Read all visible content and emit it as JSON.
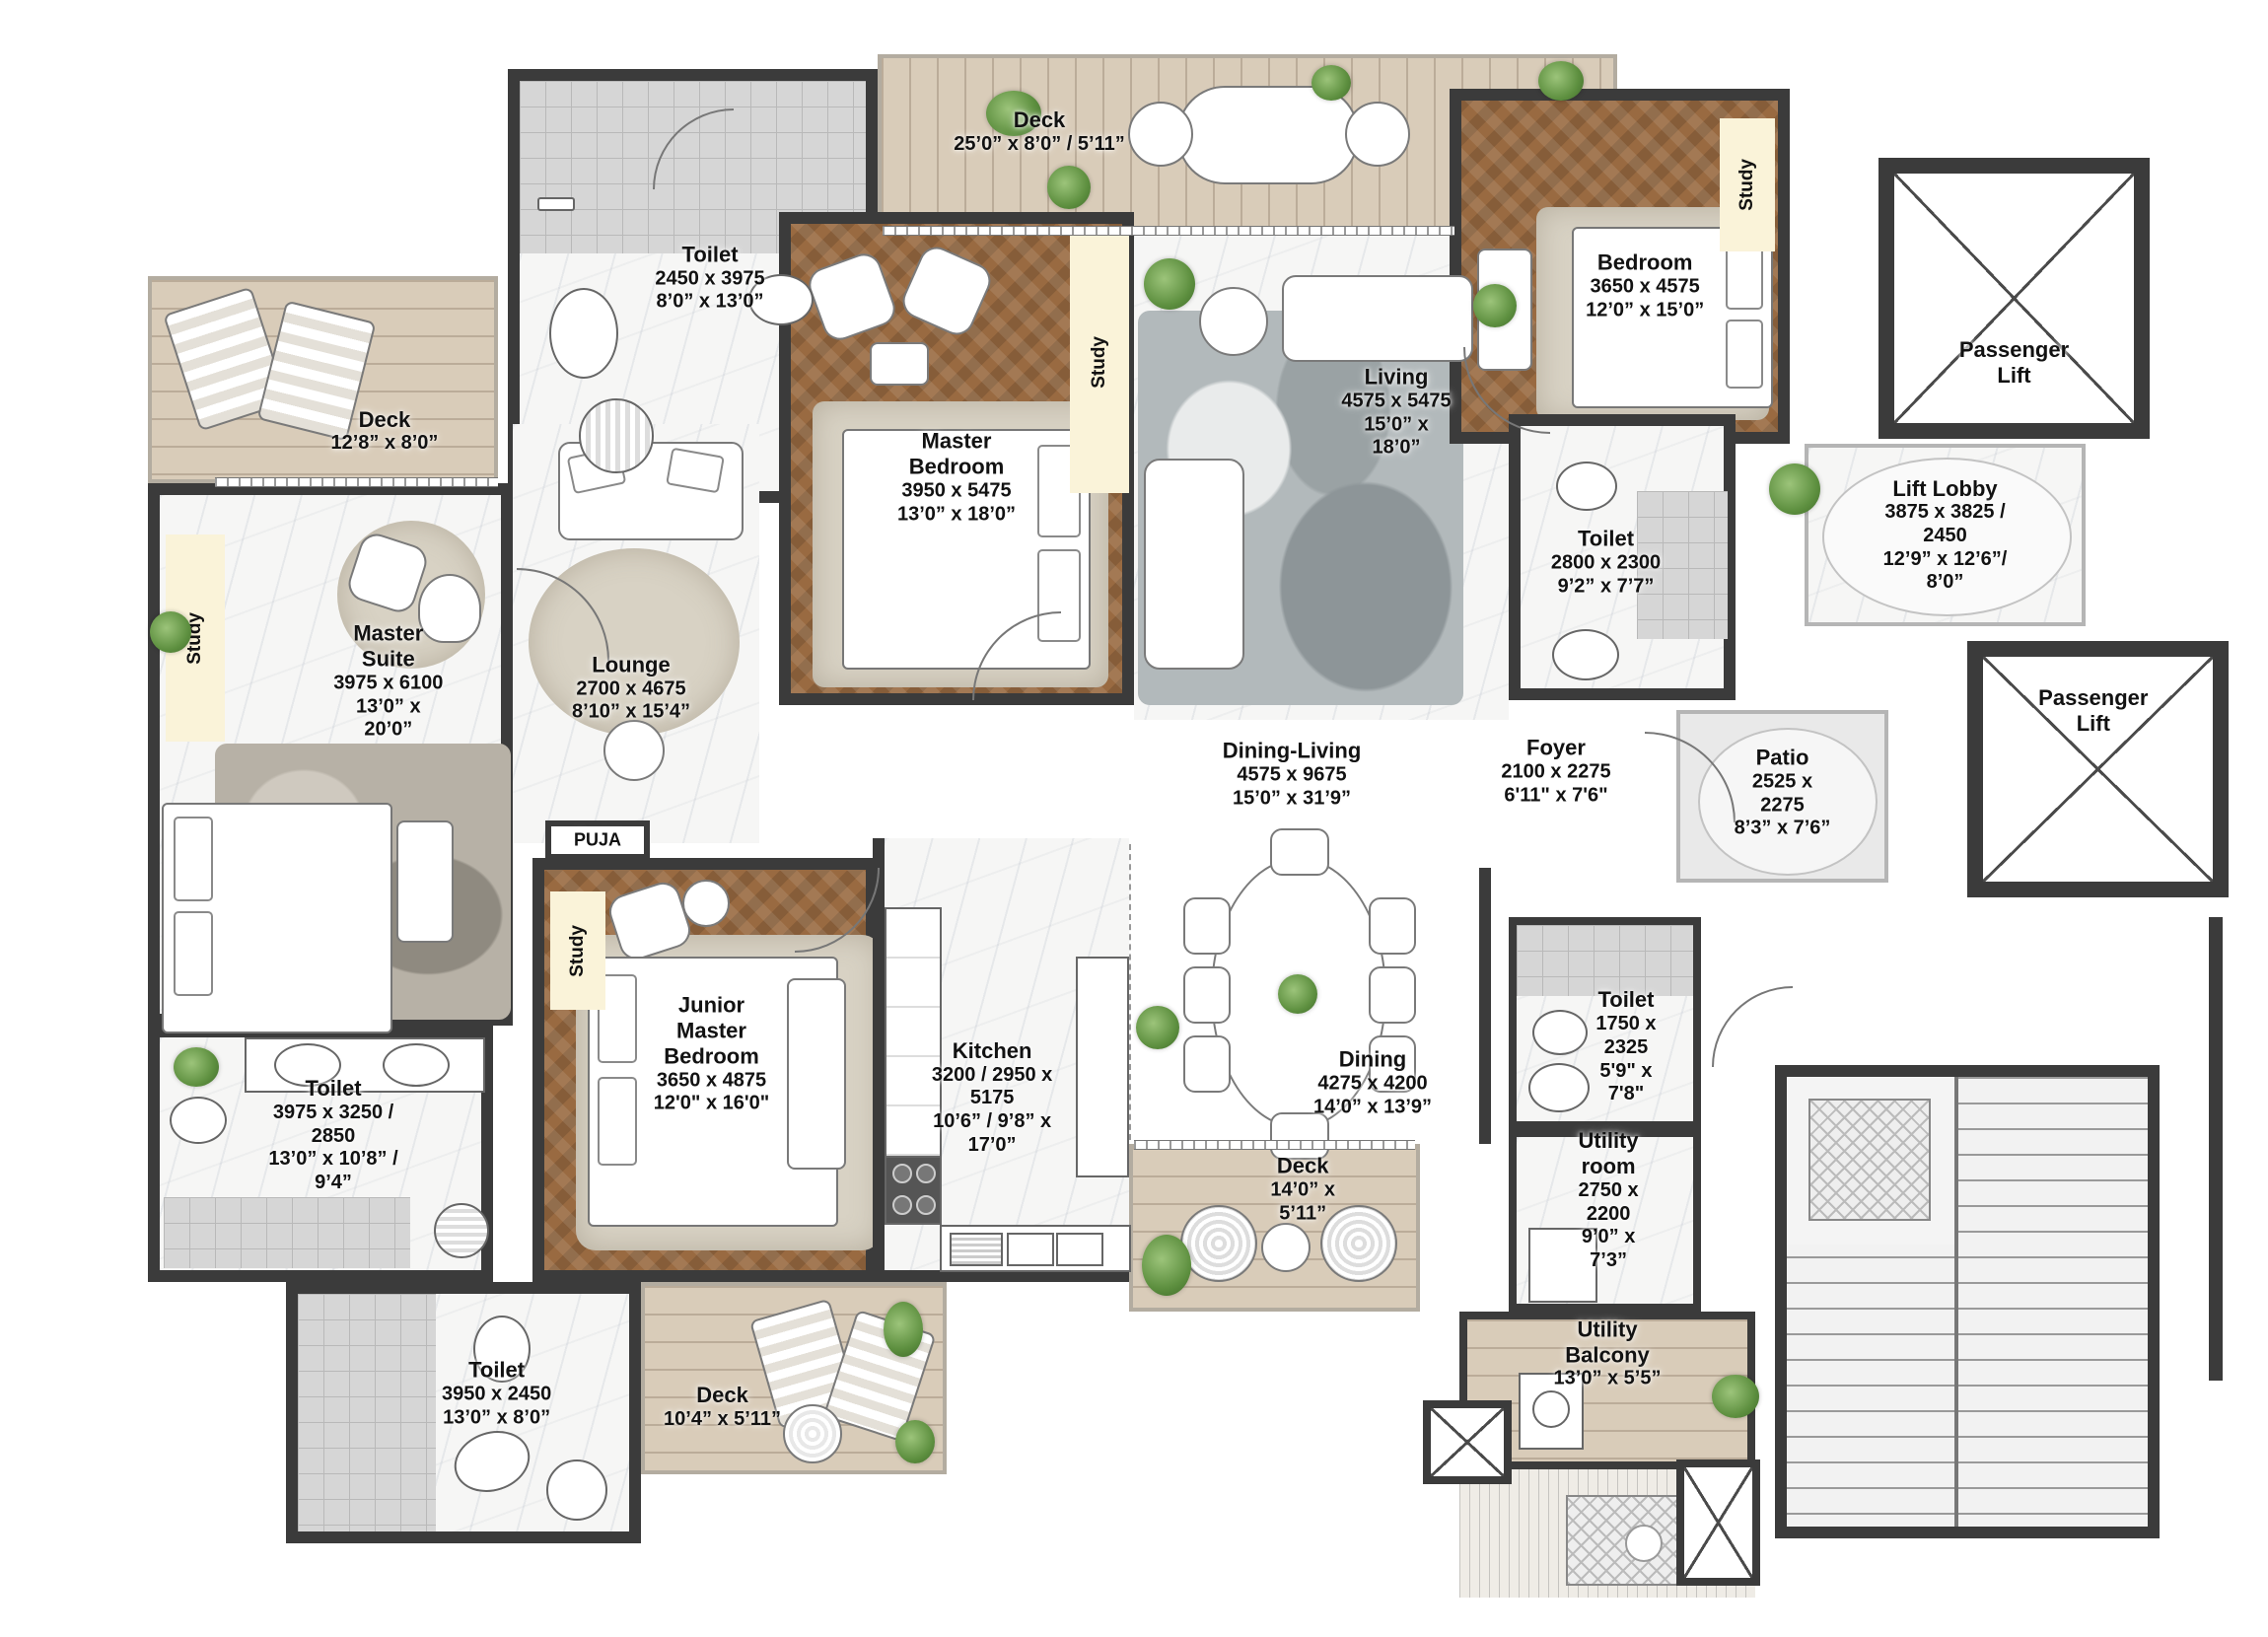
{
  "plan_title": "Apartment Floor Plan",
  "colors": {
    "wall": "#3b3b3b",
    "wood_floor": "#996a41",
    "deck_floor": "#d9ccb9",
    "marble_floor": "#f6f6f5",
    "tile_floor": "#d6d6d6",
    "study_nook": "#faf3d9",
    "plant_green": "#5d8f3f"
  },
  "labels": {
    "study": "Study",
    "puja": "PUJA",
    "passenger_lift": "Passenger Lift"
  },
  "rooms": {
    "toilet_tl": {
      "name": "Toilet",
      "mm": "2450 x 3975",
      "ft": "8’0” x 13’0”"
    },
    "deck_top": {
      "name": "Deck",
      "ft": "25’0” x 8’0”  / 5’11”"
    },
    "master_bedroom": {
      "name": "Master Bedroom",
      "mm": "3950 x 5475",
      "ft": "13’0” x 18’0”"
    },
    "living": {
      "name": "Living",
      "mm": "4575 x 5475",
      "ft": "15’0” x 18’0”"
    },
    "bedroom": {
      "name": "Bedroom",
      "mm": "3650 x 4575",
      "ft": "12’0” x 15’0”"
    },
    "lift_lobby": {
      "name": "Lift Lobby",
      "mm": "3875 x 3825 / 2450",
      "ft": "12’9” x 12’6”/ 8’0”"
    },
    "toilet_mid": {
      "name": "Toilet",
      "mm": "2800 x 2300",
      "ft": "9’2” x 7’7”"
    },
    "foyer": {
      "name": "Foyer",
      "mm": "2100 x 2275",
      "ft": "6'11\" x 7'6\""
    },
    "patio": {
      "name": "Patio",
      "mm": "2525 x 2275",
      "ft": "8’3” x 7’6”"
    },
    "deck_left": {
      "name": "Deck",
      "ft": "12’8” x 8’0”"
    },
    "master_suite": {
      "name": "Master Suite",
      "mm": "3975 x 6100",
      "ft": "13’0” x 20’0”"
    },
    "lounge": {
      "name": "Lounge",
      "mm": "2700 x 4675",
      "ft": "8’10” x 15’4”"
    },
    "junior_master": {
      "name": "Junior\nMaster Bedroom",
      "mm": "3650 x 4875",
      "ft": "12'0\" x 16'0\""
    },
    "dining_living": {
      "name": "Dining-Living",
      "mm": "4575 x 9675",
      "ft": "15’0” x 31’9”"
    },
    "dining": {
      "name": "Dining",
      "mm": "4275 x 4200",
      "ft": "14’0” x 13’9”"
    },
    "kitchen": {
      "name": "Kitchen",
      "mm": "3200 / 2950  x 5175",
      "ft": "10’6” / 9’8” x 17’0”"
    },
    "deck_mid": {
      "name": "Deck",
      "ft": "14’0” x 5’11”"
    },
    "toilet_small": {
      "name": "Toilet",
      "mm": "1750 x 2325",
      "ft": "5'9\" x 7'8\""
    },
    "utility_room": {
      "name": "Utility room",
      "mm": "2750 x 2200",
      "ft": "9’0” x 7’3”"
    },
    "utility_balcony": {
      "name": "Utility Balcony",
      "ft": "13’0” x 5’5”"
    },
    "toilet_bl": {
      "name": "Toilet",
      "mm": "3975 x 3250 / 2850",
      "ft": "13’0” x 10’8” / 9’4”"
    },
    "toilet_b": {
      "name": "Toilet",
      "mm": "3950 x 2450",
      "ft": "13’0” x 8’0”"
    },
    "deck_bottom": {
      "name": "Deck",
      "ft": "10’4” x 5’11”"
    }
  }
}
